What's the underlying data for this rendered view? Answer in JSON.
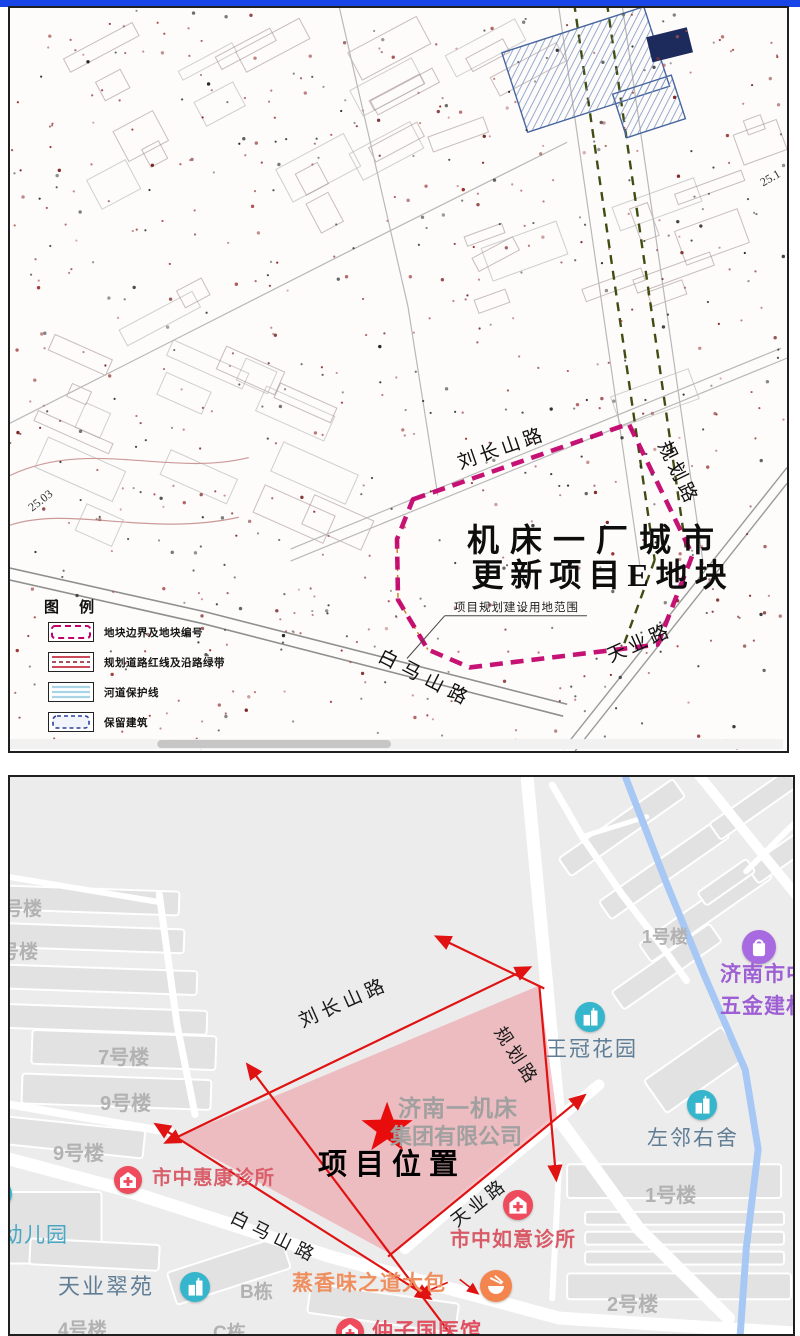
{
  "colors": {
    "top_bar": "#1745e8",
    "scan_background": "#fdfcfa",
    "boundary_magenta": "#c2006b",
    "green_belt_line": "#3f4d12",
    "project_fill_pink": "#f0a7ab",
    "red_planning_line": "#e01212",
    "star_red": "#e80c0c",
    "stream_blue": "#a7c8f5",
    "poi_teal": "#35b6cc",
    "poi_red": "#ee4c5c",
    "poi_orange": "#f5854e",
    "poi_purple": "#a86ae0",
    "label_blue_gray": "#5f7d95",
    "label_kindergarten": "#49a7c4",
    "label_clinic": "#d95f6b",
    "label_restaurant": "#ef8e5e",
    "label_market": "#9d5fd3",
    "label_building_gray": "#b2b2b2"
  },
  "top_map": {
    "title_line1": "机床一厂城市",
    "title_line2": "更新项目E地块",
    "boundary_note": "项目规划建设用地范围",
    "roads": {
      "liuchangshan": "刘长山路",
      "guihua": "规划路",
      "baimashan": "白马山路",
      "tianye": "天业路"
    },
    "elevation_left": "25.03",
    "elevation_right": "25.1",
    "legend": {
      "title": "图 例",
      "items": [
        {
          "symbol": "plot-boundary",
          "label": "地块边界及地块编号"
        },
        {
          "symbol": "road-redline",
          "label": "规划道路红线及沿路绿带"
        },
        {
          "symbol": "river-protection",
          "label": "河道保护线"
        },
        {
          "symbol": "retained-building",
          "label": "保留建筑"
        }
      ]
    }
  },
  "bottom_map": {
    "project_label": "项目位置",
    "company_line1": "济南一机床",
    "company_line2": "集团有限公司",
    "roads": {
      "liuchangshan": "刘长山路",
      "guihua": "规划路",
      "baimashan": "白马山路",
      "tianye": "天业路"
    },
    "pois": [
      {
        "name": "王冠花园",
        "type": "residential"
      },
      {
        "name": "左邻右舍",
        "type": "residential"
      },
      {
        "name": "济南市中",
        "name2": "五金建材",
        "type": "market"
      },
      {
        "name": "市中惠康诊所",
        "type": "clinic"
      },
      {
        "name": "市中如意诊所",
        "type": "clinic"
      },
      {
        "name": "天业翠苑",
        "type": "residential"
      },
      {
        "name": "幼儿园",
        "type": "kindergarten"
      },
      {
        "name": "蒸香味之道大包",
        "type": "restaurant"
      },
      {
        "name": "仲子国医馆",
        "type": "clinic"
      }
    ],
    "building_labels": [
      "号楼",
      "号楼",
      "7号楼",
      "9号楼",
      "9号楼",
      "1号楼",
      "1号楼",
      "2号楼",
      "4号楼",
      "B栋",
      "C栋"
    ]
  }
}
